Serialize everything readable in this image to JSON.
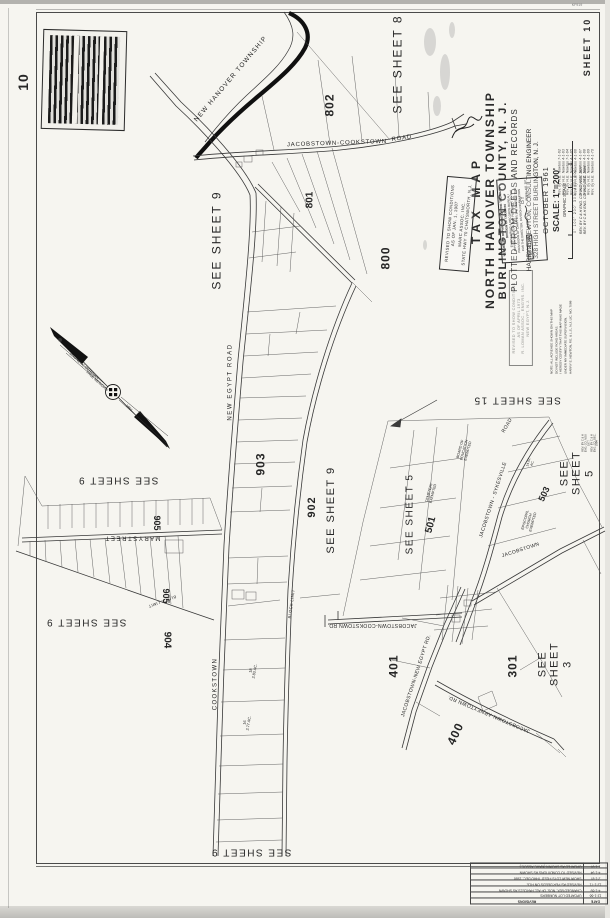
{
  "page": {
    "big_sheet_number": "10",
    "corner_mark": "KF919"
  },
  "title_block": {
    "line1": "TAX MAP",
    "line2": "NORTH HANOVER TOWNSHIP",
    "line3": "BURLINGTON COUNTY, N. J.",
    "line4": "PLOTTED FROM DEEDS AND RECORDS",
    "line5": "BY",
    "line6": "HARRY E. NEWTON, CONSULTING ENGINEER",
    "line7": "328 HIGH STREET      BURLINGTON, N. J.",
    "line8": "OCTOBER 1961",
    "line9": "SCALE: 1\"=200'",
    "line10": "GRAPHIC SCALE",
    "scale_ticks": "0'    100'   200'   300'   400'   500'",
    "rev_note1": "REV. BY C & H ENG. CO. INC.  NOV. 1977",
    "rev_note2": "REV. BY C & H ENG. CO. INC.  DEC. 1984",
    "sheet_label": "SHEET 10"
  },
  "revision_list": {
    "entries": [
      "Rev. by H.E. Newton   7-1-62",
      "Rev. by H.E. Newton   4-1-63",
      "Rev. by H.E. Newton   7-1-64",
      "Rev. by H.E. Newton   4-1-65",
      "Rev. by H.E. Newton   4-1-66",
      "Rev. by H.E. Newton   4-1-67",
      "Rev. by H.E. Newton   4-1-68",
      "Rev. by H.E. Newton   4-1-69",
      "Rev. by H.E. Newton   4-1-70"
    ]
  },
  "note_block": {
    "l1": "NOTE: ALL ACREAGE SHOWN ON THIS MAP",
    "l2": "DO NOT INCLUDE ROAD AREAS.",
    "l3": "I HEREBY CERTIFY THAT THIS MAP WAS MADE",
    "l4": "UNDER MY IMMEDIATE SUPERVISION.",
    "l5": "HARRY E. NEWTON, P.E. & L.S., N.J. LIC. NO. 7088"
  },
  "treasury_stamp": {
    "l1": "NEW JERSEY DEPARTMENT OF THE TREASURY",
    "l2": "DIVISION OF TAXATION",
    "l3": "ENGINEERING & RECORDS BUREAU",
    "l4": "APPROVED AS TAX MAP PURSUANT TO THE",
    "l5": "PROVISIONS OF CHAPTER 175, LAWS OF 1913",
    "l6": "FOR THE DIRECTOR, DIVISION OF TAXATION",
    "date_stamp": "FEB 20 1964",
    "serial": "SERIAL NO. 387"
  },
  "revised_1987_box": {
    "l1": "REVISED TO SHOW CONDITIONS",
    "l2": "AS OF    JAN. 1,    1987",
    "l3": "MARC ASSOC. INC.",
    "l4": "STATE HWY 70    CHATSWORTH, N.J."
  },
  "revised_1973_box": {
    "l1": "REVISED TO SHOW CONDITIONS",
    "l2": "AS OF    APRIL  1973",
    "l3": "R. LOMAN ASSOC., ENG'RS. INC.",
    "l4": "NEW EGYPT, N.J."
  },
  "bottom_table": {
    "headers": [
      "DATE",
      "REVISIONS"
    ],
    "rows": [
      [
        "12-1-66",
        "UPDATED LOT NUMBERS"
      ],
      [
        "4-1-69",
        "CHANGED BLK. NOS. OF ALL PARCELS AS SHOWN"
      ],
      [
        "12-1-71",
        "REVISED AS PER DEEDS ON FILE"
      ],
      [
        "2-1-87",
        "SHOW NEW LOTS FILED THRU DEC. 1986"
      ],
      [
        "4-1-94",
        "REVISED TO CONDITIONS AS SHOWN"
      ],
      [
        "1-1-97",
        "UPDATED AS SHOWN  (MARC ASSOC.)"
      ]
    ]
  },
  "map_labels": [
    {
      "name": "sheet-number-corner",
      "text": "10",
      "x": 24,
      "y": 82,
      "rot": -90,
      "fs": 14,
      "bold": true,
      "ls": 1
    },
    {
      "name": "corner-mark",
      "text": "KF919",
      "x": 577,
      "y": 5,
      "rot": 0,
      "fs": 3.6,
      "color": "#777"
    },
    {
      "name": "see-sheet-8",
      "text": "SEE SHEET 8",
      "x": 398,
      "y": 64,
      "rot": -90,
      "fs": 12,
      "ls": 2
    },
    {
      "name": "see-sheet-9-upper",
      "text": "SEE SHEET 9",
      "x": 217,
      "y": 240,
      "rot": -90,
      "fs": 12,
      "ls": 2
    },
    {
      "name": "see-sheet-9-mid",
      "text": "SEE SHEET 9",
      "x": 331,
      "y": 510,
      "rot": -90,
      "fs": 11,
      "ls": 1.5
    },
    {
      "name": "see-sheet-5-left",
      "text": "SEE SHEET 5",
      "x": 410,
      "y": 514,
      "rot": -90,
      "fs": 10,
      "ls": 1.5
    },
    {
      "name": "see-sheet-5-right",
      "text": "SEE SHEET 5",
      "x": 577,
      "y": 473,
      "rot": -90,
      "fs": 11,
      "ls": 1.5
    },
    {
      "name": "see-sheet-3",
      "text": "SEE SHEET 3",
      "x": 555,
      "y": 664,
      "rot": -90,
      "fs": 11,
      "ls": 1.5
    },
    {
      "name": "see-sheet-15",
      "text": "SEE SHEET 15",
      "x": 517,
      "y": 400,
      "rot": 180,
      "fs": 10,
      "ls": 1.5
    },
    {
      "name": "see-sheet-9-mary-1",
      "text": "SEE SHEET 9",
      "x": 118,
      "y": 480,
      "rot": 180,
      "fs": 10,
      "ls": 1.5
    },
    {
      "name": "see-sheet-9-mary-2",
      "text": "SEE SHEET 9",
      "x": 86,
      "y": 622,
      "rot": 180,
      "fs": 10,
      "ls": 1.5
    },
    {
      "name": "see-sheet-9-bottom",
      "text": "SEE SHEET 9",
      "x": 251,
      "y": 852,
      "rot": 180,
      "fs": 10,
      "ls": 1.5
    },
    {
      "name": "block-802",
      "text": "802",
      "x": 330,
      "y": 105,
      "rot": -90,
      "fs": 12,
      "bold": true,
      "ls": 1
    },
    {
      "name": "block-801",
      "text": "801",
      "x": 310,
      "y": 200,
      "rot": -90,
      "fs": 10,
      "bold": true
    },
    {
      "name": "block-800",
      "text": "800",
      "x": 386,
      "y": 258,
      "rot": -90,
      "fs": 12,
      "bold": true,
      "ls": 1
    },
    {
      "name": "block-903",
      "text": "903",
      "x": 261,
      "y": 464,
      "rot": -90,
      "fs": 12,
      "bold": true,
      "ls": 1
    },
    {
      "name": "block-902",
      "text": "902",
      "x": 312,
      "y": 507,
      "rot": -90,
      "fs": 11,
      "bold": true,
      "ls": 1
    },
    {
      "name": "block-905a",
      "text": "905",
      "x": 157,
      "y": 523,
      "rot": 90,
      "fs": 9,
      "bold": true
    },
    {
      "name": "block-905b",
      "text": "905",
      "x": 166,
      "y": 596,
      "rot": 90,
      "fs": 9,
      "bold": true
    },
    {
      "name": "block-904",
      "text": "904",
      "x": 167,
      "y": 640,
      "rot": 90,
      "fs": 10,
      "bold": true
    },
    {
      "name": "block-501",
      "text": "501",
      "x": 431,
      "y": 525,
      "rot": -75,
      "fs": 10,
      "bold": true
    },
    {
      "name": "block-503",
      "text": "503",
      "x": 544,
      "y": 494,
      "rot": -65,
      "fs": 9,
      "bold": true
    },
    {
      "name": "block-401",
      "text": "401",
      "x": 394,
      "y": 666,
      "rot": -90,
      "fs": 12,
      "bold": true,
      "ls": 1
    },
    {
      "name": "block-400",
      "text": "400",
      "x": 456,
      "y": 734,
      "rot": -65,
      "fs": 12,
      "bold": true,
      "ls": 1
    },
    {
      "name": "block-301",
      "text": "301",
      "x": 513,
      "y": 666,
      "rot": -90,
      "fs": 12,
      "bold": true,
      "ls": 1
    },
    {
      "name": "boundary-new-hanover-township",
      "text": "NEW  HANOVER  TOWNSHIP",
      "x": 231,
      "y": 79,
      "rot": -50,
      "fs": 6.5,
      "ls": 1.2
    },
    {
      "name": "road-jacobstown-cookstown",
      "text": "JACOBSTOWN-COOKSTOWN",
      "x": 337,
      "y": 144,
      "rot": -2,
      "fs": 6,
      "ls": 0.8
    },
    {
      "name": "road-jacobstown-cookstown-word-road",
      "text": "ROAD",
      "x": 402,
      "y": 139,
      "rot": -8,
      "fs": 6,
      "ls": 0.8
    },
    {
      "name": "road-new-egypt",
      "text": "NEW  EGYPT  ROAD",
      "x": 231,
      "y": 382,
      "rot": -90,
      "fs": 6,
      "ls": 1.6
    },
    {
      "name": "road-cookstown",
      "text": "COOKSTOWN",
      "x": 216,
      "y": 684,
      "rot": -90,
      "fs": 6,
      "ls": 1.4
    },
    {
      "name": "road-jacobstown-cookstown-mid",
      "text": "JACOBSTOWN-COOKSTOWN  RD.",
      "x": 372,
      "y": 624,
      "rot": 180,
      "fs": 5,
      "ls": 0.4
    },
    {
      "name": "road-jacobstown-new-egypt",
      "text": "JACOBSTOWN-NEW EGYPT  RD.",
      "x": 417,
      "y": 676,
      "rot": -72,
      "fs": 5,
      "ls": 0.4
    },
    {
      "name": "road-jacobstown-arneytown",
      "text": "JACOBSTOWN-ARNEYTOWN  RD.",
      "x": 489,
      "y": 713,
      "rot": 203,
      "fs": 5,
      "ls": 0.4
    },
    {
      "name": "road-jacobstown-sykesville",
      "text": "JACOBSTOWN - SYKESVILLE",
      "x": 494,
      "y": 500,
      "rot": -72,
      "fs": 5,
      "ls": 0.4
    },
    {
      "name": "road-sykesville-word-road",
      "text": "ROAD",
      "x": 508,
      "y": 426,
      "rot": -60,
      "fs": 5,
      "ls": 0.4
    },
    {
      "name": "road-jacobstown-short",
      "text": "JACOBSTOWN",
      "x": 521,
      "y": 551,
      "rot": -18,
      "fs": 5,
      "ls": 0.4
    },
    {
      "name": "street-mary",
      "text": "M A R Y     S T R E E T",
      "x": 133,
      "y": 537,
      "rot": 180,
      "fs": 6
    },
    {
      "name": "block-limit-east",
      "text": "BLOCK  LIMIT",
      "x": 292,
      "y": 604,
      "rot": -82,
      "fs": 4,
      "ls": 0.4
    },
    {
      "name": "block-limit-mary",
      "text": "BLOCK  LIMIT",
      "x": 162,
      "y": 601,
      "rot": 160,
      "fs": 4,
      "ls": 0.4
    },
    {
      "name": "annot-cemetery",
      "text": "CEMETERY\nEXEMPTED",
      "x": 431,
      "y": 493,
      "rot": -75,
      "fs": 3.6
    },
    {
      "name": "annot-board-of-education",
      "text": "BOARD OF\nEDUCATION\nEXEMPTED",
      "x": 464,
      "y": 450,
      "rot": -75,
      "fs": 3.6
    },
    {
      "name": "annot-episcopal-church",
      "text": "EPISCOPAL\nCHURCH\nEXEMPTED",
      "x": 529,
      "y": 521,
      "rot": -75,
      "fs": 3.6
    },
    {
      "name": "annot-lot18",
      "text": "18\n2.83 AC.",
      "x": 253,
      "y": 671,
      "rot": -80,
      "fs": 3.8
    },
    {
      "name": "annot-lot16",
      "text": "16\n2.77 AC.",
      "x": 247,
      "y": 723,
      "rot": -80,
      "fs": 3.8
    },
    {
      "name": "annot-1401-ac",
      "text": "14.01\nAC.",
      "x": 531,
      "y": 463,
      "rot": -75,
      "fs": 3.4
    },
    {
      "name": "compass-label-magnetic",
      "text": "MAGNETIC  MERIDIAN",
      "x": 84,
      "y": 366,
      "rot": 42,
      "fs": 3.6
    },
    {
      "name": "compass-label-true",
      "text": "TRUE  MERIDIAN",
      "x": 97,
      "y": 381,
      "rot": 42,
      "fs": 3.6
    },
    {
      "name": "compass-year",
      "text": "1961",
      "x": 129,
      "y": 408,
      "rot": 42,
      "fs": 3.6
    },
    {
      "name": "margin-rev-note",
      "text": "REV. BY C & H ENG. CO.  NOV. 1977\nREV. BY C & H ENG. CO.  DEC. 1984",
      "x": 591,
      "y": 443,
      "rot": -90,
      "fs": 2.6
    }
  ]
}
